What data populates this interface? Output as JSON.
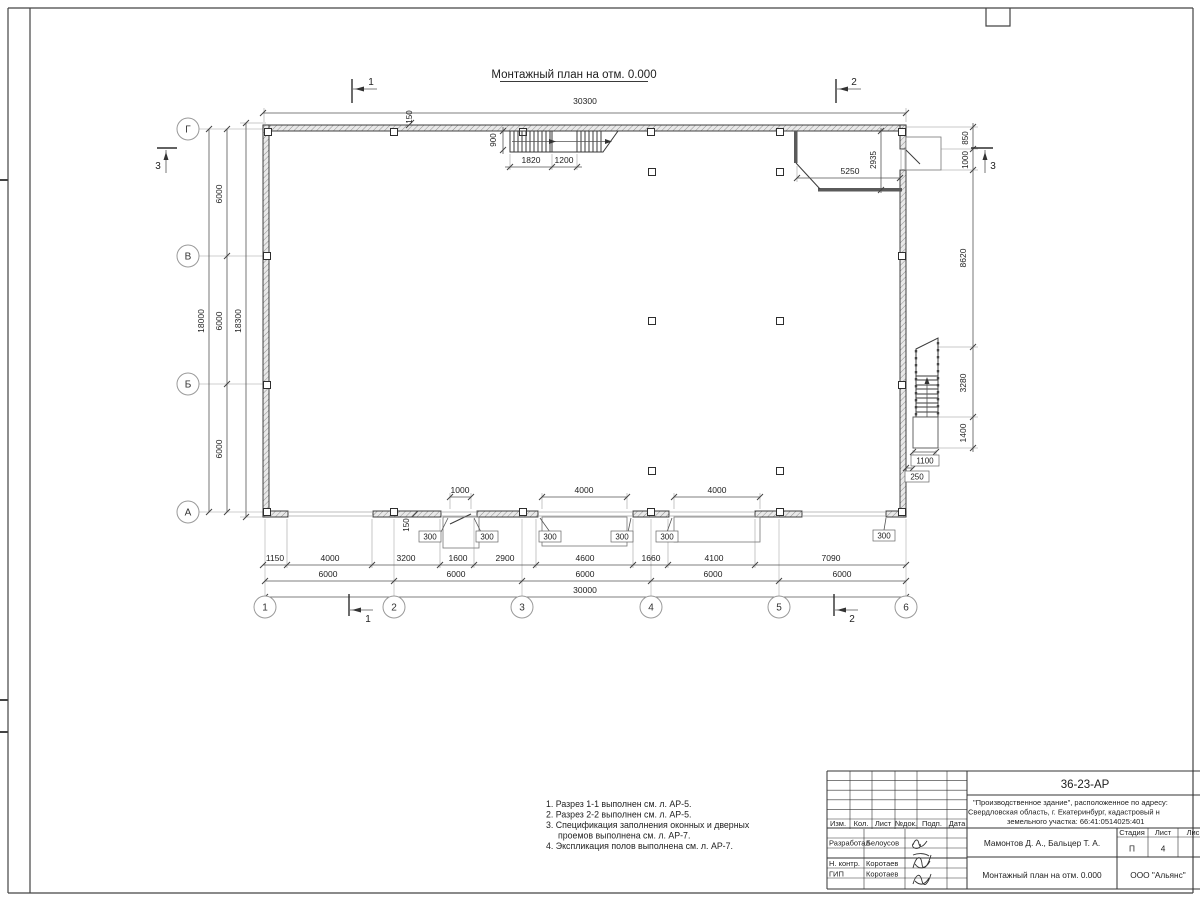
{
  "drawing": {
    "title": "Монтажный план на отм. 0.000"
  },
  "grid": {
    "rows": [
      "Г",
      "В",
      "Б",
      "А"
    ],
    "cols": [
      "1",
      "2",
      "3",
      "4",
      "5",
      "6"
    ]
  },
  "sections": {
    "cut1": "1",
    "cut2": "2",
    "cut3": "3"
  },
  "dims": {
    "top_overall": "30300",
    "wall_offset_top": "150",
    "wall_offset_bottom": "150",
    "stair_depth": "900",
    "stair_flight": "1820",
    "stair_landing": "1200",
    "tambour_w": "5250",
    "tambour_h": "2935",
    "door_offset": "850",
    "door_opening": "1000",
    "right_upper": "8620",
    "right_stair": "3280",
    "right_landing": "1400",
    "stair_width": "1100",
    "stair_gap": "250",
    "left_bays": [
      "6000",
      "6000",
      "6000"
    ],
    "left_total": "18000",
    "left_overall": "18300",
    "bottom_detail": [
      "1150",
      "4000",
      "3200",
      "1600",
      "2900",
      "4600",
      "1660",
      "4100",
      "7090"
    ],
    "bottom_bays": [
      "6000",
      "6000",
      "6000",
      "6000",
      "6000"
    ],
    "bottom_overall": "30000",
    "door_leaf": "1000",
    "gate1": "4000",
    "gate2": "4000",
    "reveals": [
      "300",
      "300",
      "300",
      "300",
      "300",
      "300"
    ]
  },
  "notes": [
    "1. Разрез 1-1 выполнен см. л. АР-5.",
    "2. Разрез 2-2 выполнен см. л. АР-5.",
    "3. Спецификация заполнения оконных и дверных",
    "проемов выполнена см. л. АР-7.",
    "4. Экспликация полов выполнена см. л. АР-7."
  ],
  "title_block": {
    "doc_number": "36-23-АР",
    "object_line1": "\"Производственное здание\", расположенное по адресу:",
    "object_line2": "Свердловская область, г. Екатеринбург, кадастровый н",
    "object_line3": "земельного участка: 66:41:0514025:401",
    "rev_cols": [
      "Изм.",
      "Кол.",
      "Лист",
      "№док.",
      "Подп.",
      "Дата"
    ],
    "role1": "Разработал",
    "name1": "Белоусов",
    "role2": "Н. контр.",
    "name2": "Коротаев",
    "role3": "ГИП",
    "name3": "Коротаев",
    "authors": "Мамонтов Д. А., Бальцер Т. А.",
    "stage_h": "Стадия",
    "sheet_h": "Лист",
    "sheets_h": "Лис",
    "stage": "П",
    "sheet": "4",
    "sheet_title": "Монтажный план на отм. 0.000",
    "company": "ООО \"Альянс\""
  }
}
